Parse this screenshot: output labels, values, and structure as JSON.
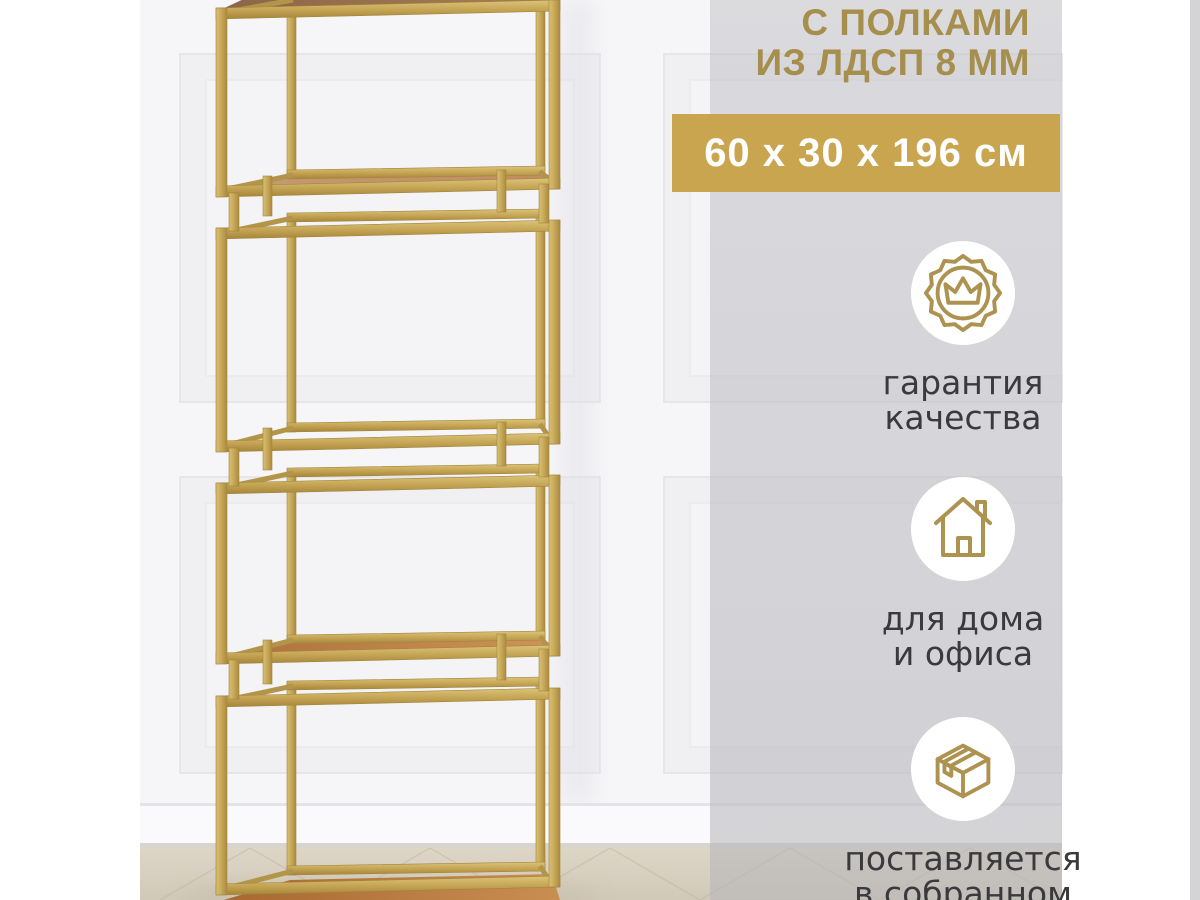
{
  "colors": {
    "accent_gold": "#c8a54e",
    "title_gold": "#a68e4c",
    "icon_gold": "#ae9350",
    "metal_gold": "#c6a757",
    "wood_brown": "#b5713d",
    "panel_gray": "#d3d3d6",
    "caption_dark": "#3a3a3c"
  },
  "overlay": {
    "material_note": {
      "line1": "С ПОЛКАМИ",
      "line2": "ИЗ ЛДСП 8 ММ"
    },
    "dimensions_badge": "60 x 30 x 196 см",
    "features": [
      {
        "icon": "quality-seal-crown-icon",
        "line1": "гарантия",
        "line2": "качества"
      },
      {
        "icon": "house-icon",
        "line1": "для дома",
        "line2": "и офиса"
      },
      {
        "icon": "package-box-icon",
        "line1": "поставляется",
        "line2": "в собранном"
      }
    ]
  }
}
